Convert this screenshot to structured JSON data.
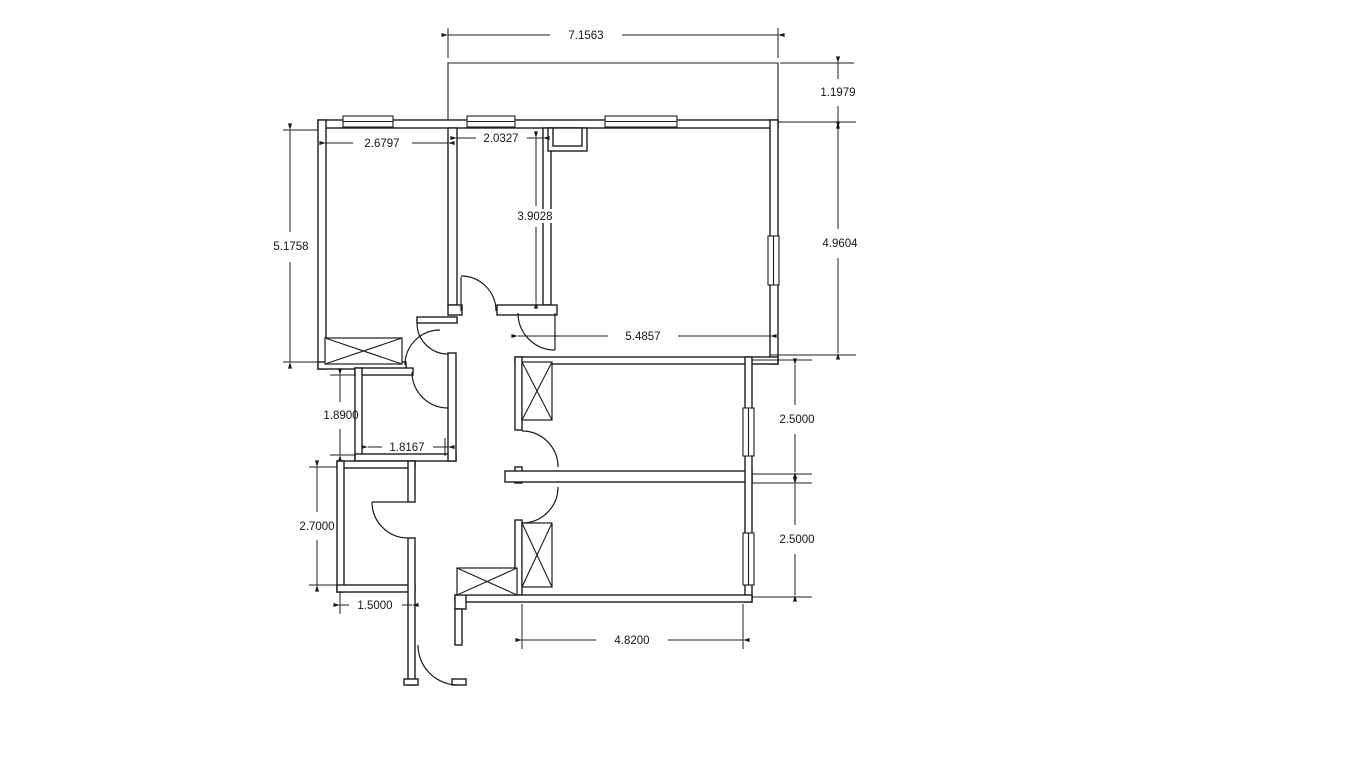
{
  "page": {
    "background": "#ffffff"
  },
  "drawing": {
    "type": "architectural-floor-plan",
    "line_color": "#1c1c1c",
    "dimensions": {
      "balcony_width": "7.1563",
      "balcony_depth": "1.1979",
      "room1_width": "2.6797",
      "room2_width": "2.0327",
      "room2_height": "3.9028",
      "left_wing_height": "5.1758",
      "living_width": "5.4857",
      "living_height": "4.9604",
      "bath_height": "1.8900",
      "bath_width": "1.8167",
      "wc_height": "2.7000",
      "wc_width": "1.5000",
      "bedroom1_height": "2.5000",
      "bedroom2_height": "2.5000",
      "bedrooms_width": "4.8200"
    }
  }
}
